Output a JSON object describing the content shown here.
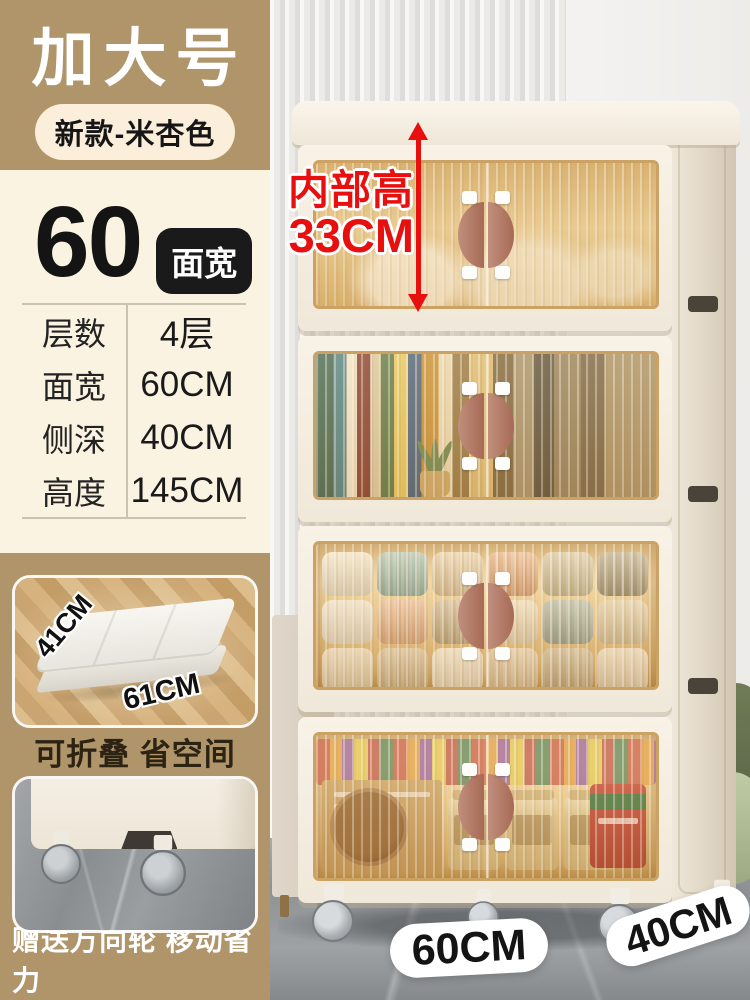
{
  "header": {
    "title": "加大号",
    "subtitle": "新款-米杏色"
  },
  "spec": {
    "width_number": "60",
    "width_badge": "面宽",
    "rows": [
      {
        "label": "层数",
        "value": "4层"
      },
      {
        "label": "面宽",
        "value": "60CM"
      },
      {
        "label": "侧深",
        "value": "40CM"
      },
      {
        "label": "高度",
        "value": "145CM"
      }
    ]
  },
  "promo": {
    "fold": {
      "dim_short": "41CM",
      "dim_long": "61CM",
      "caption": "可折叠 省空间"
    },
    "wheels": {
      "caption": "赠送万向轮 移动省力"
    }
  },
  "photo": {
    "annotation": {
      "label": "内部高",
      "value": "33CM"
    },
    "floor_labels": {
      "width": "60CM",
      "depth": "40CM"
    }
  },
  "colors": {
    "accent_red": "#E80F0F",
    "brand_tan": "#B0956B",
    "panel_cream": "#FBF3E2",
    "badge_black": "#1A1A1A",
    "pill_cream": "#FBEEDB"
  }
}
